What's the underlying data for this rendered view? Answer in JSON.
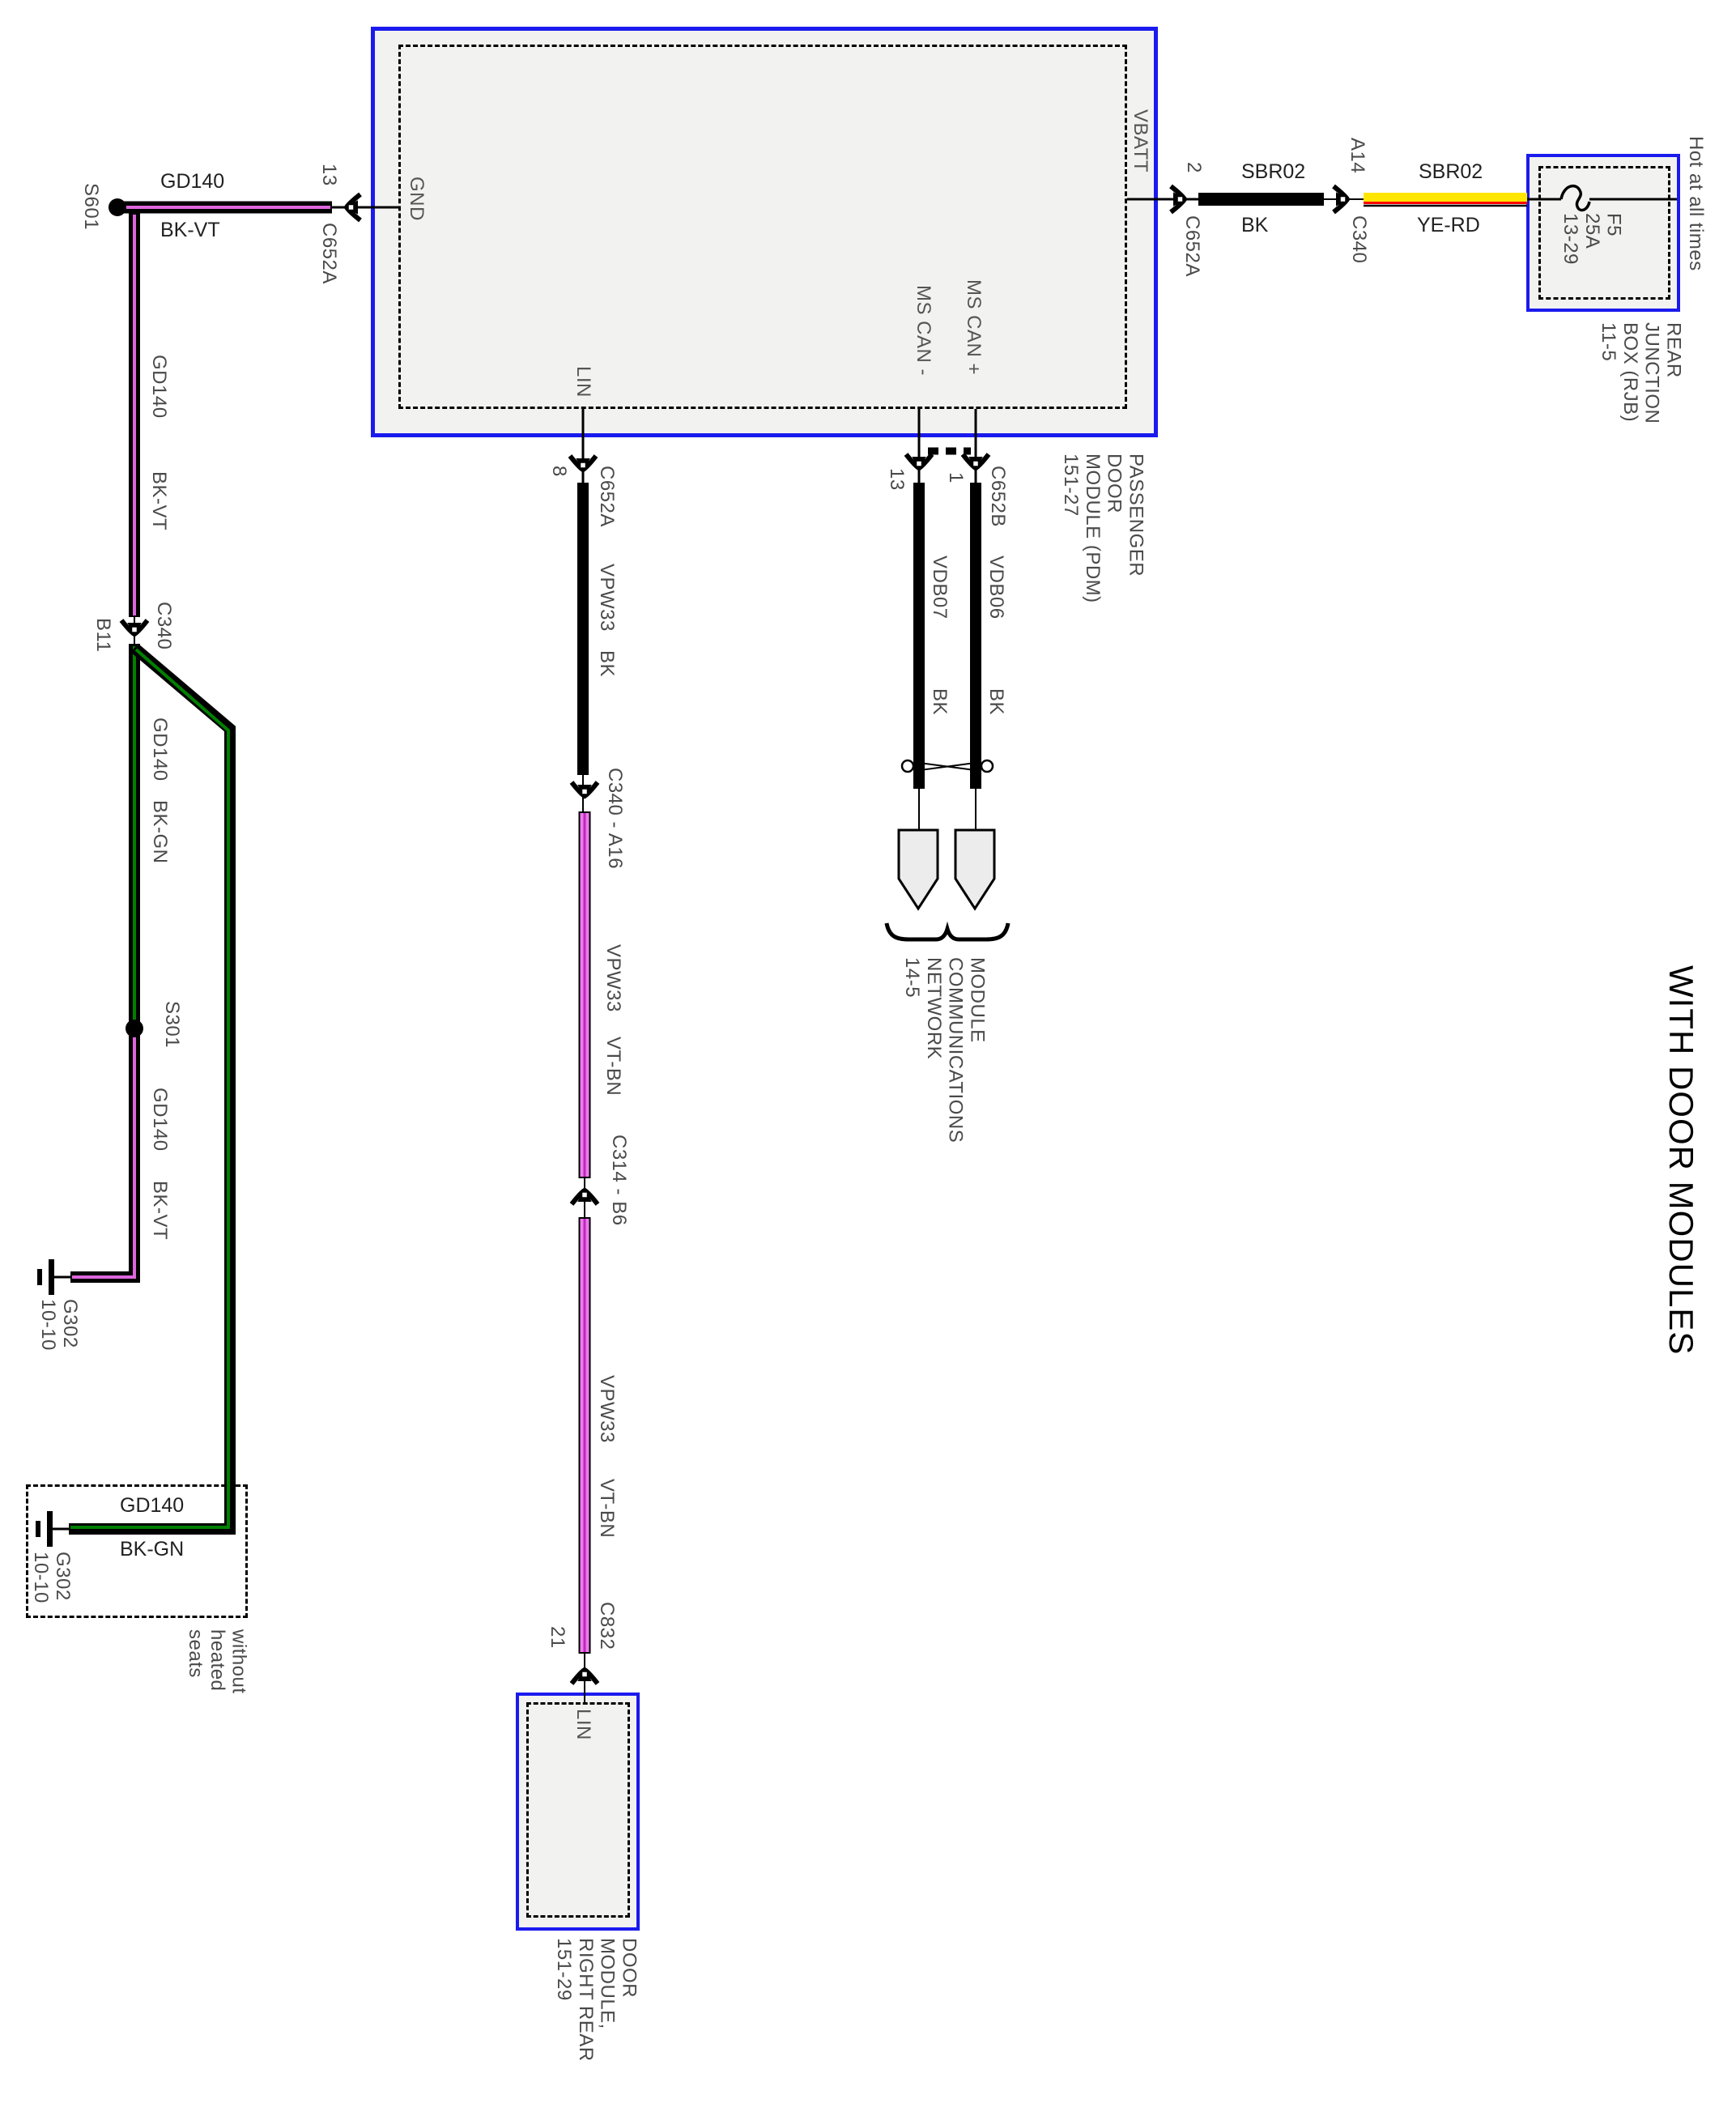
{
  "title": "WITH DOOR MODULES",
  "hot_note": "Hot at all times",
  "variant_note": "without\nheated\nseats",
  "boxes": {
    "pdm": {
      "label": "PASSENGER\nDOOR\nMODULE (PDM)\n151-27",
      "pins": {
        "gnd": "GND",
        "vbatt": "VBATT",
        "ms_can_plus": "MS CAN +",
        "ms_can_minus": "MS CAN -",
        "lin": "LIN"
      }
    },
    "rjb": {
      "label": "REAR\nJUNCTION\nBOX (RJB)\n11-5",
      "fuse": "F5\n25A\n13-29"
    },
    "door_rr": {
      "label": "DOOR\nMODULE,\nRIGHT REAR\n151-29",
      "pin_lin": "LIN"
    },
    "network": {
      "label": "MODULE\nCOMMUNICATIONS\nNETWORK\n14-5"
    }
  },
  "splices": {
    "s601": "S601",
    "s301": "S301"
  },
  "grounds": {
    "g302_upper": "G302\n10-10",
    "g302_lower": "G302\n10-10"
  },
  "connectors": {
    "gnd_pin": "13",
    "gnd_conn": "C652A",
    "vbatt_pin": "2",
    "vbatt_conn": "C652A",
    "a14_pin": "A14",
    "a14_conn": "C340",
    "b11_pin": "B11",
    "b11_conn": "C340",
    "lin_pin": "8",
    "lin_conn": "C652A",
    "c340_a16": "C340 - A16",
    "c314_b6": "C314 - B6",
    "c832_pin": "21",
    "c832_conn": "C832",
    "mscan_minus_pin": "13",
    "mscan_plus_pin": "1",
    "mscan_conn": "C652B"
  },
  "wires": {
    "gnd_top": {
      "circuit": "GD140",
      "color": "BK-VT"
    },
    "left_upper": {
      "circuit": "GD140",
      "color": "BK-VT"
    },
    "left_mid": {
      "circuit": "GD140",
      "color": "BK-GN"
    },
    "left_lower": {
      "circuit": "GD140",
      "color": "BK-VT"
    },
    "heated_box": {
      "circuit": "GD140",
      "color": "BK-GN"
    },
    "sbr02_bk": {
      "circuit": "SBR02",
      "color": "BK"
    },
    "sbr02_yerd": {
      "circuit": "SBR02",
      "color": "YE-RD"
    },
    "lin_upper": {
      "circuit": "VPW33",
      "color": "BK"
    },
    "lin_mid": {
      "circuit": "VPW33",
      "color": "VT-BN"
    },
    "lin_lower": {
      "circuit": "VPW33",
      "color": "VT-BN"
    },
    "can_minus": {
      "circuit": "VDB07",
      "color": "BK"
    },
    "can_plus": {
      "circuit": "VDB06",
      "color": "BK"
    }
  },
  "colors": {
    "black": "#000000",
    "violet_stripe": "#dd66dd",
    "green_stripe": "#008000",
    "yellow": "#ffe600",
    "red_stripe": "#ff0000",
    "pink_body": "#ee7bee",
    "pink_stripe": "#bb29bb",
    "module_blue": "#1a1aee"
  }
}
